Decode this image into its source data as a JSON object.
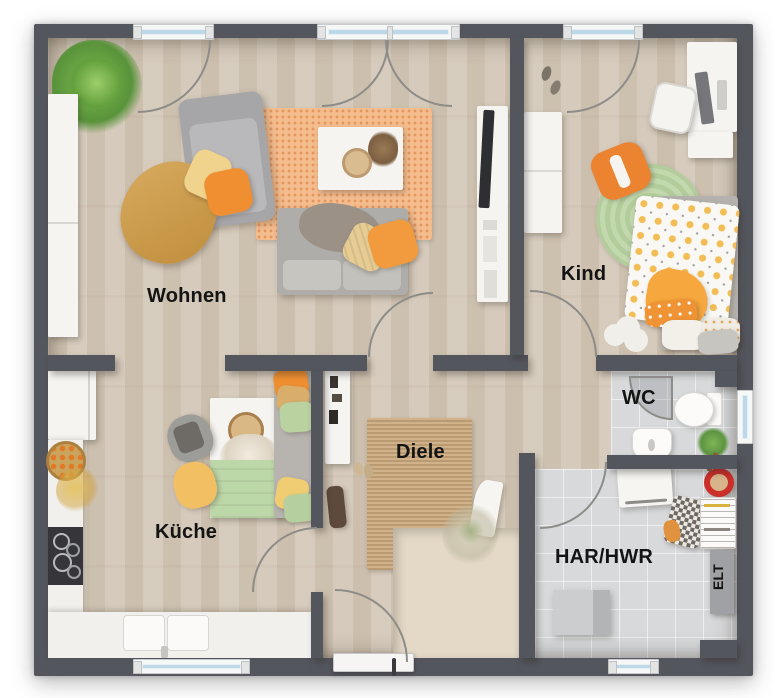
{
  "labels": {
    "wohnen": "Wohnen",
    "kind": "Kind",
    "kueche": "Küche",
    "diele": "Diele",
    "wc": "WC",
    "har_hwr": "HAR/HWR",
    "elt": "ELT"
  },
  "colors": {
    "wall": "#54565e",
    "wood_floor": "#d2c6b6",
    "tile_floor": "#d7d9db",
    "window_glass": "#bcd9ea",
    "label_text": "#141414",
    "rug_orange": "#f5bd8e",
    "rug_jute": "#c9a87e",
    "rug_green": "#bad2a4",
    "accent_orange": "#ef8f31",
    "accent_yellow": "#f0cd72",
    "accent_green": "#b9d2a0",
    "sofa_gray": "#aeada9",
    "stairs_wood": "#e7dccb"
  }
}
